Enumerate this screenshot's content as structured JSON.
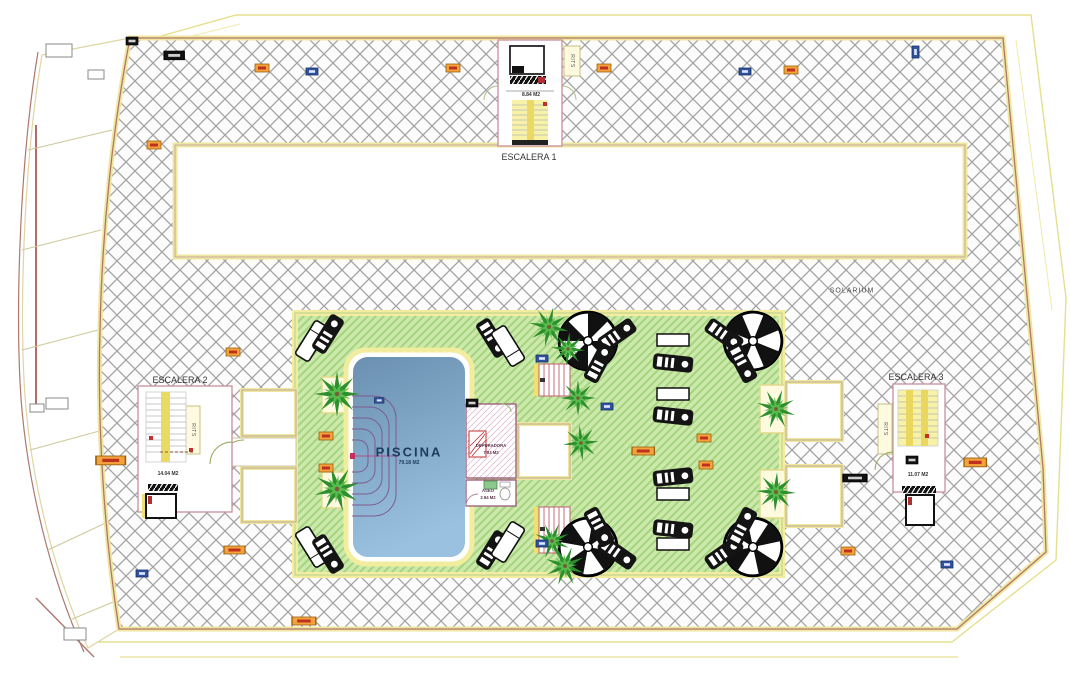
{
  "plan": {
    "escalera1": {
      "title": "ESCALERA 1",
      "area": "8.84 M2",
      "shaft_label": "RITS"
    },
    "escalera2": {
      "title": "ESCALERA 2",
      "area": "14.04 M2",
      "shaft_label": "RITS"
    },
    "escalera3": {
      "title": "ESCALERA 3",
      "area": "11.07 M2",
      "shaft_label": "RITS"
    },
    "pool": {
      "title": "PISCINA",
      "area": "79.18 M2"
    },
    "depuradora": {
      "title": "DEPURADORA",
      "area": "7.83 M2"
    },
    "aseo": {
      "title": "ASEO",
      "area": "2.94 M2"
    },
    "solarium_label": "SOLARIUM"
  },
  "icons": {
    "parasol": "beach-umbrella-icon",
    "palm": "palm-tree-icon",
    "black_lounger": "sun-lounger-icon",
    "white_lounger": "sun-lounger-outline-icon",
    "table": "side-table-icon",
    "orange_marker": "utility-marker-orange",
    "blue_marker": "utility-marker-blue",
    "black_marker": "utility-marker-black"
  },
  "palette": {
    "deck_hatch": "#a3a3a3",
    "green_fill": "#cde9ad",
    "green_stripe": "#a6d67f",
    "pool_top": "#6a8fb0",
    "pool_bottom": "#9ac2e0",
    "border_yellow": "#efe79d",
    "outline_maroon": "#b0766f",
    "room_outline": "#c98f9b",
    "marker_orange": "#f3a33b",
    "marker_blue": "#31539b",
    "marker_black": "#111111"
  }
}
